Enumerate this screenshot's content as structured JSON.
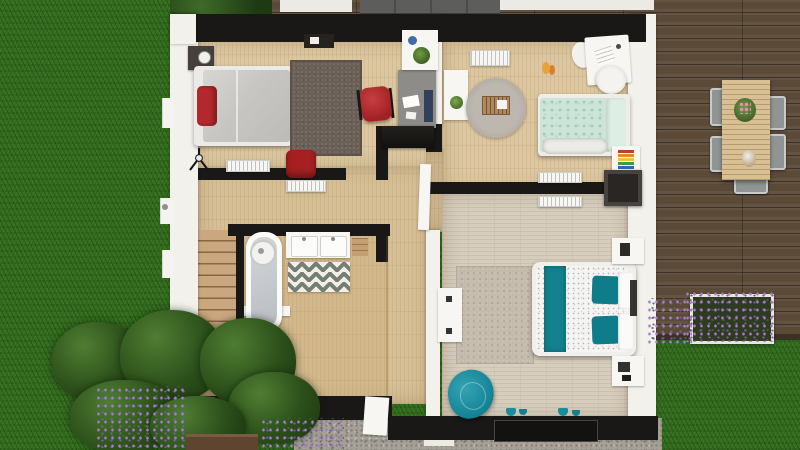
{
  "meta": {
    "type": "3D architectural floor plan render, top-down view",
    "floor": "Upper floor with two bedrooms, kids room, bathroom, hallway and winder staircase"
  },
  "palette": {
    "grass": "#336c1e",
    "deck_wood": "#5c4a39",
    "floor_wood": "#dcc7a0",
    "hall_wood": "#d6bf96",
    "master_floor": "#d6cdbd",
    "wall_dark": "#1a1816",
    "wall_white": "#f2f1ec",
    "accent_teal": "#17879a",
    "accent_red": "#b2282c",
    "accent_mint": "#cde5d8"
  },
  "outdoor": {
    "lawn": "Lawn",
    "deck": "Wooden deck terrace",
    "outdoor_sofa": "Grey outdoor sofa",
    "dining_table": "Outdoor dining table with flower pot",
    "dining_chairs": "Outdoor metal chairs",
    "planter": "Deck planter box with lavender",
    "shrubs": "Garden shrubs",
    "lavender": "Lavender flowers",
    "patio": "Gravel patio",
    "window_planter": "Wooden planter under hedge",
    "curb": "White parapet ledge"
  },
  "rooms": {
    "bedroom1": {
      "name": "Bedroom 1",
      "items": {
        "bed": "Double bed with grey duvet and red pillow",
        "nightstand": "Dark nightstand with lamp",
        "rug": "Dark grey rug",
        "desk": "Grey desk with laptop and papers",
        "desk_chair": "Red desk chair",
        "shelf": "White shelf with plant and blue cup",
        "wall_shelf": "Black wall shelf",
        "console": "Black console table",
        "pouf": "Red pouf",
        "radiator": "Radiator",
        "floor_lamp": "Black tripod floor lamp"
      }
    },
    "kids_room": {
      "name": "Kids bedroom",
      "items": {
        "bed": "Single bed with mint patterned duvet and fur throw",
        "desk": "White desk with two chairs",
        "side_table": "White side table with plant",
        "rug": "Round grey rug with toy crib",
        "toy": "Stacking rings toy on white shelf",
        "toy_floor": "Orange toy on floor",
        "wardrobe": "Dark grey wardrobe",
        "radiator_top": "Radiator",
        "radiator_bottom": "Radiator pair on party wall"
      }
    },
    "master_bedroom": {
      "name": "Master bedroom",
      "items": {
        "bed": "Double bed with white speckled duvet, teal runner and teal pillows",
        "nightstand_top": "White nightstand",
        "nightstand_bottom": "White nightstand with accessories",
        "rug": "Beige textured rug",
        "armchair": "Teal swivel armchair",
        "dresser": "White dresser",
        "door": "White interior door (open)",
        "patio_door": "Dark patio door",
        "decor": "Small teal floor decorations"
      }
    },
    "bathroom": {
      "name": "Bathroom",
      "items": {
        "bathtub": "Bathtub with shower head",
        "vanity": "Double sink vanity",
        "rug": "Chevron rug",
        "toilet": "Toilet with wooden cistern shelf",
        "shelf": "Wooden shelf",
        "scale": "Bathroom scale"
      }
    },
    "hallway": {
      "name": "Hallway / landing",
      "items": {
        "stairs": "Staircase with winder steps",
        "radiator": "Radiator",
        "front_door": "White entry door",
        "kids_door": "Kids room door opening"
      }
    }
  }
}
